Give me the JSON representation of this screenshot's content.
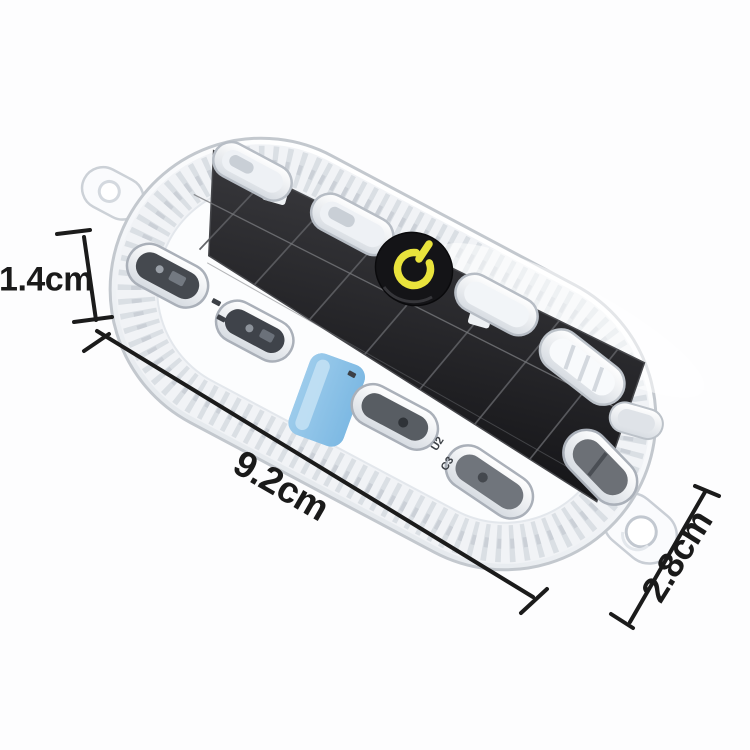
{
  "dimensions": {
    "height_label": "1.4cm",
    "length_label": "9.2cm",
    "width_label": "2.8cm"
  },
  "pcb_marks": {
    "mark1": "U2",
    "mark2": "C3"
  },
  "icons": {
    "power_button": "power-icon"
  },
  "colors": {
    "dimension": "#1b1b1b",
    "case_stroke": "#c3c8ce",
    "solar_panel_light": "#3a3a3e",
    "solar_panel_dark": "#17171a",
    "button_black": "#141417",
    "power_yellow": "#e9e33c",
    "battery_blue": "#7db9e3"
  }
}
